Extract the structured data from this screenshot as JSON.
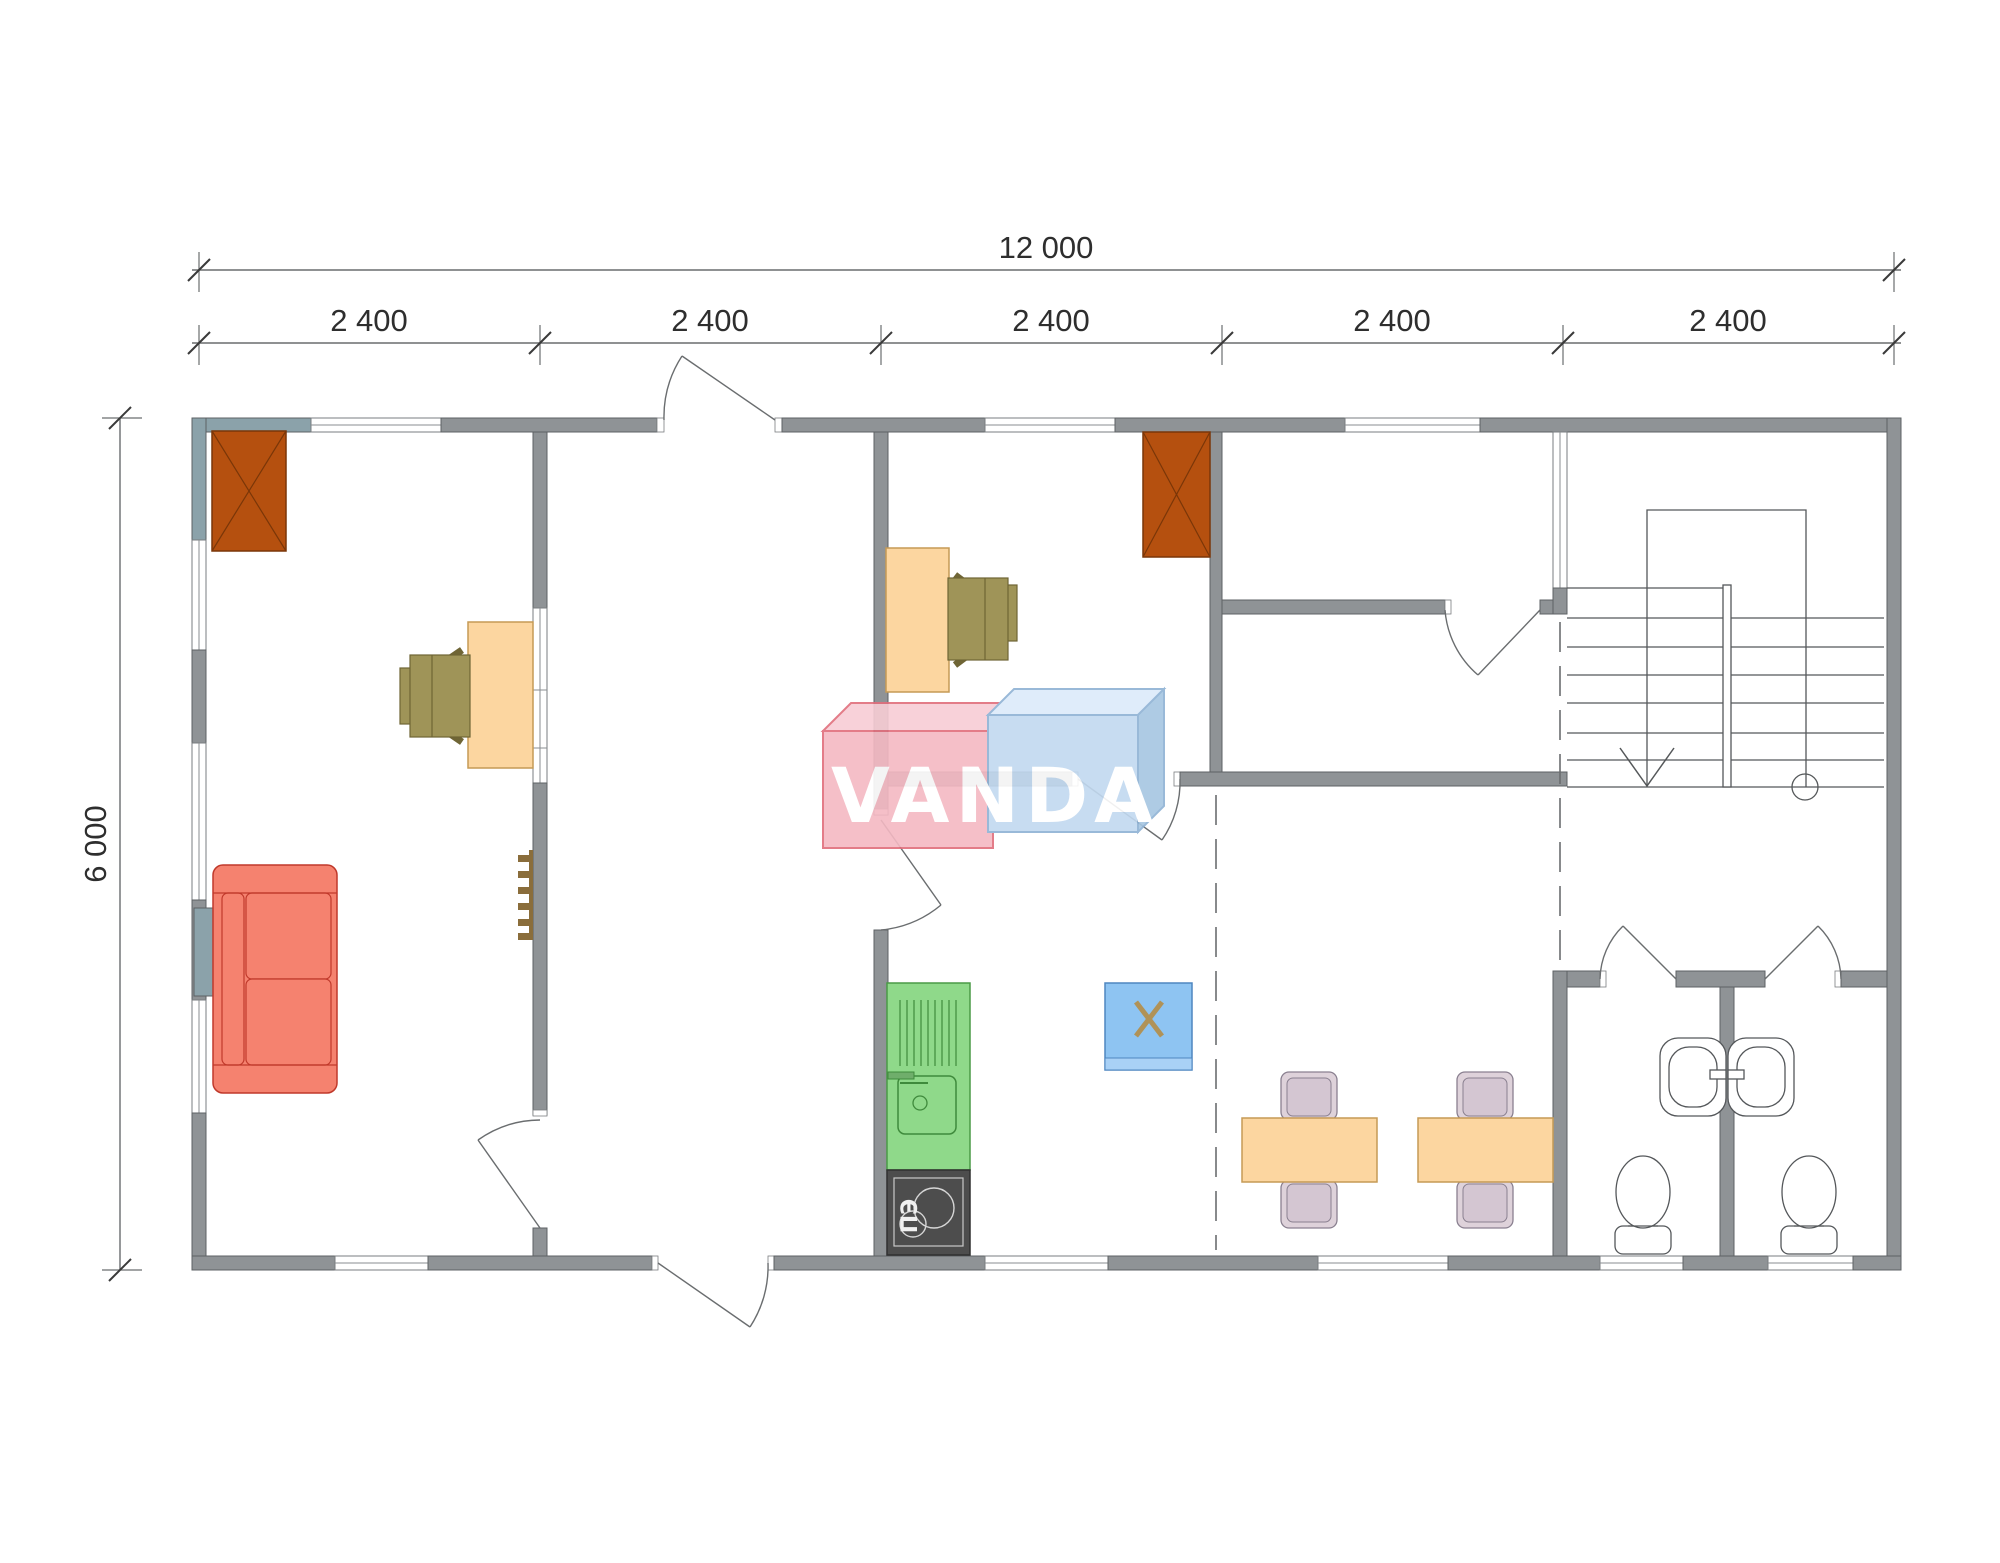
{
  "drawing": {
    "type": "floor-plan",
    "dimensions": {
      "total_width": "12 000",
      "total_height": "6 000",
      "bays": [
        "2 400",
        "2 400",
        "2 400",
        "2 400",
        "2 400"
      ]
    },
    "logo": {
      "text": "VANDA",
      "pink_color": "#f4b9c3",
      "blue_color": "#c2d9f0"
    },
    "equipment": {
      "stove_label": "ПЭ"
    },
    "colors": {
      "wall": "#8f9396",
      "wall_accent": "#8ba2aa",
      "chimney": "#b5500f",
      "desk_table": "#fcd6a0",
      "office_chair": "#9f9458",
      "sofa": "#f5826f",
      "kitchen_counter": "#8fd98a",
      "stove": "#4d4d4d",
      "water_heater": "#8ec4f2",
      "dining_chair": "#ded2da"
    },
    "furniture_symbols": [
      "chimney-flue",
      "office-desk",
      "office-chair",
      "sofa",
      "wall-radiator",
      "kitchen-sink-counter",
      "electric-stove",
      "water-heater",
      "dining-table",
      "dining-chair",
      "washbasin",
      "toilet",
      "staircase"
    ]
  }
}
